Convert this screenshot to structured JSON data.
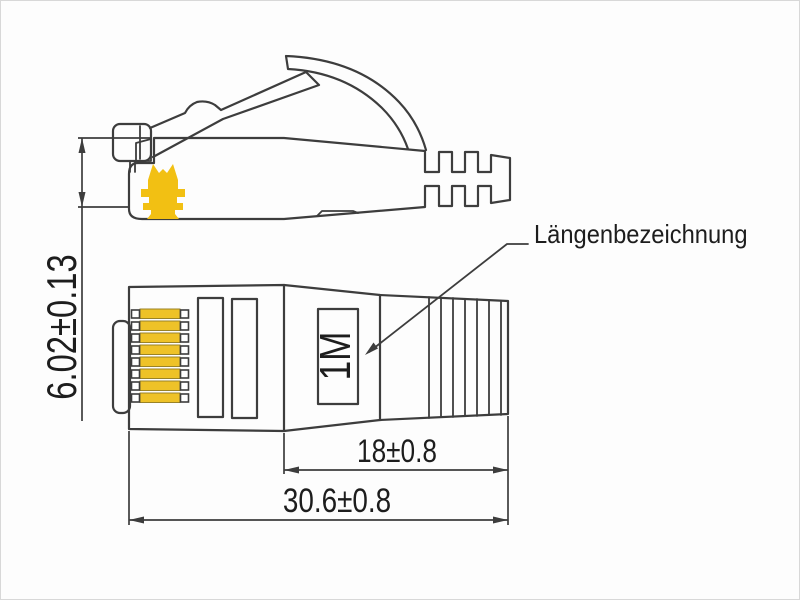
{
  "diagram": {
    "annotation_label": "Längenbezeichnung",
    "connector_marking": "1M",
    "dimensions": {
      "front_height": "6.02±0.13",
      "boot_length": "18±0.8",
      "total_length": "30.6±0.8"
    }
  },
  "colors": {
    "line": "#3d3d3d",
    "text": "#1d1d1d",
    "logo_yellow": "#f2c013",
    "contact_gold": "#eec228",
    "background": "#fdfdfd"
  }
}
